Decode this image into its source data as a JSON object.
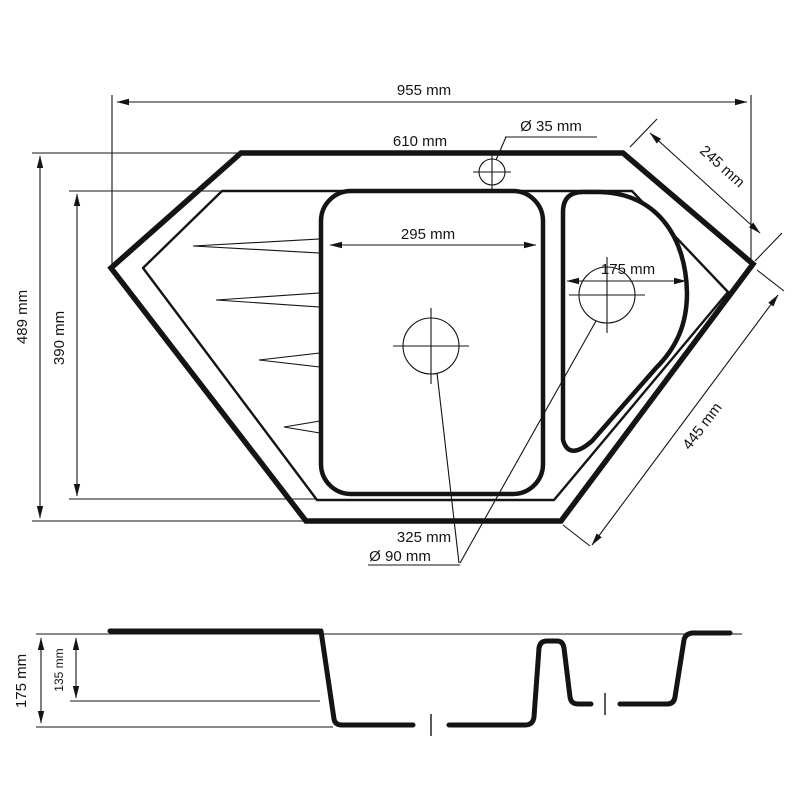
{
  "colors": {
    "ink": "#141414",
    "background": "#ffffff"
  },
  "top_view": {
    "total_width": "955 mm",
    "top_edge_width": "610 mm",
    "faucet_hole_diameter": "Ø 35 mm",
    "top_right_edge_length": "245 mm",
    "total_depth": "489 mm",
    "inner_depth": "390 mm",
    "main_bowl_width": "295 mm",
    "small_bowl_width": "175 mm",
    "bottom_right_edge_length": "445 mm",
    "main_bowl_bottom_width": "325 mm",
    "drain_diameter": "Ø 90 mm"
  },
  "section_view": {
    "main_bowl_depth": "175 mm",
    "small_bowl_depth": "135 mm"
  }
}
